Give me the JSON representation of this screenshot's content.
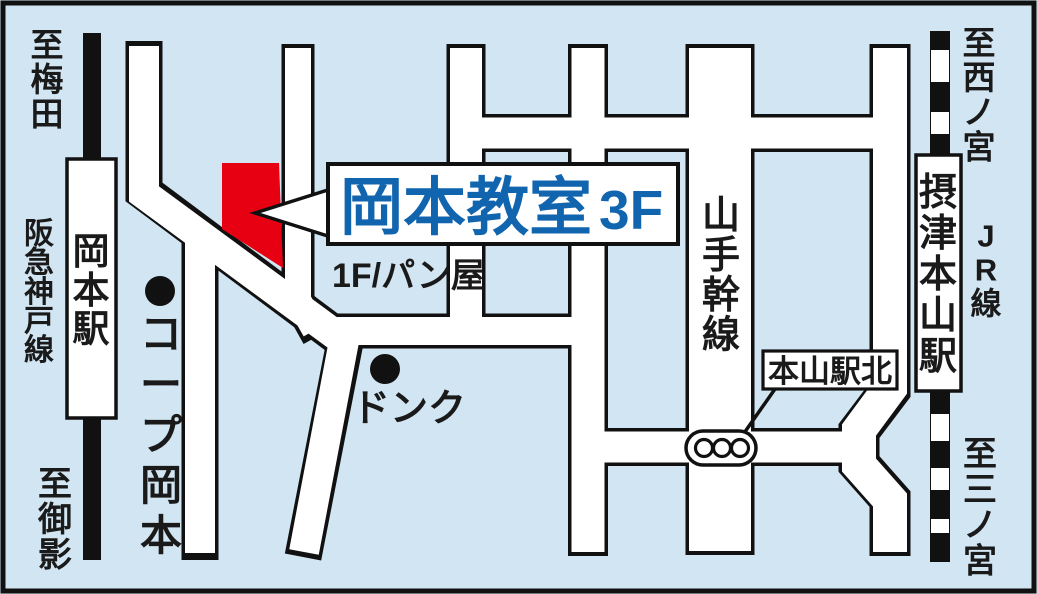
{
  "map": {
    "type": "access-map",
    "destination": {
      "name": "岡本教室",
      "floor": "3F",
      "ground_floor_note": "1F/パン屋"
    },
    "stations": [
      {
        "name": "岡本駅",
        "railway": "阪急神戸線"
      },
      {
        "name": "摂津本山駅",
        "railway": "JR線"
      }
    ],
    "directions": [
      "至梅田",
      "至御影",
      "至西ノ宮",
      "至三ノ宮"
    ],
    "landmarks": [
      "コープ岡本",
      "ドンク"
    ],
    "main_road": "山手幹線",
    "intersection": "本山駅北",
    "colors": {
      "background": "#d2e5f2",
      "road_fill": "#ffffff",
      "outline": "#111111",
      "destination_red": "#e60012",
      "title_blue": "#1164ae",
      "text_black": "#1a1a1a"
    },
    "labels": [
      {
        "id": "to-umeda",
        "text": "至梅田",
        "x": 47,
        "y": 26,
        "size": 33,
        "dir": "v",
        "weight": 700,
        "color": "#1a1a1a"
      },
      {
        "id": "hankyu-kobe-line",
        "text": "阪急神戸線",
        "x": 39,
        "y": 216,
        "size": 30,
        "dir": "v",
        "weight": 700,
        "color": "#1a1a1a",
        "sp": 0.97
      },
      {
        "id": "okamoto-station",
        "text": "岡本駅",
        "x": 91,
        "y": 230,
        "size": 37,
        "dir": "v",
        "weight": 700,
        "color": "#1a1a1a"
      },
      {
        "id": "to-mikage",
        "text": "至御影",
        "x": 55,
        "y": 464,
        "size": 34,
        "dir": "v",
        "weight": 700,
        "color": "#1a1a1a"
      },
      {
        "id": "coop-okamoto",
        "text": "コープ岡本",
        "x": 161,
        "y": 310,
        "size": 42,
        "dir": "v",
        "weight": 700,
        "color": "#1a1a1a",
        "sp": 1.2
      },
      {
        "id": "donq",
        "text": "ドンク",
        "x": 352,
        "y": 421,
        "size": 38,
        "dir": "h",
        "weight": 700,
        "color": "#1a1a1a"
      },
      {
        "id": "bakery-1f",
        "text": "1F/パン屋",
        "x": 332,
        "y": 287,
        "size": 34,
        "dir": "h",
        "weight": 700,
        "color": "#1a1a1a"
      },
      {
        "id": "classroom-name",
        "text": "岡本教室",
        "x": 340,
        "y": 229,
        "size": 63,
        "dir": "h",
        "weight": 800,
        "color": "#1164ae"
      },
      {
        "id": "classroom-floor",
        "text": "3F",
        "x": 599,
        "y": 229,
        "size": 55,
        "dir": "h",
        "weight": 800,
        "color": "#1164ae"
      },
      {
        "id": "yamate-kansen",
        "text": "山手幹線",
        "x": 721,
        "y": 193,
        "size": 38,
        "dir": "v",
        "weight": 700,
        "color": "#1a1a1a"
      },
      {
        "id": "motoyama-eki-kita",
        "text": "本山駅北",
        "x": 830,
        "y": 382,
        "size": 31,
        "dir": "h",
        "weight": 700,
        "color": "#1a1a1a",
        "anchor": "middle"
      },
      {
        "id": "settsu-motoyama-sta",
        "text": "摂津本山駅",
        "x": 938,
        "y": 170,
        "size": 38,
        "dir": "v",
        "weight": 700,
        "color": "#1a1a1a",
        "sp": 1.08
      },
      {
        "id": "jr-line",
        "text": "JR線",
        "x": 986,
        "y": 218,
        "size": 31,
        "dir": "v",
        "weight": 700,
        "color": "#1a1a1a",
        "sp": 1.1
      },
      {
        "id": "to-nishinomiya",
        "text": "至西ノ宮",
        "x": 979,
        "y": 24,
        "size": 33,
        "dir": "v",
        "weight": 700,
        "color": "#1a1a1a"
      },
      {
        "id": "to-sannomiya",
        "text": "至三ノ宮",
        "x": 980,
        "y": 434,
        "size": 34,
        "dir": "v",
        "weight": 700,
        "color": "#1a1a1a"
      }
    ]
  }
}
